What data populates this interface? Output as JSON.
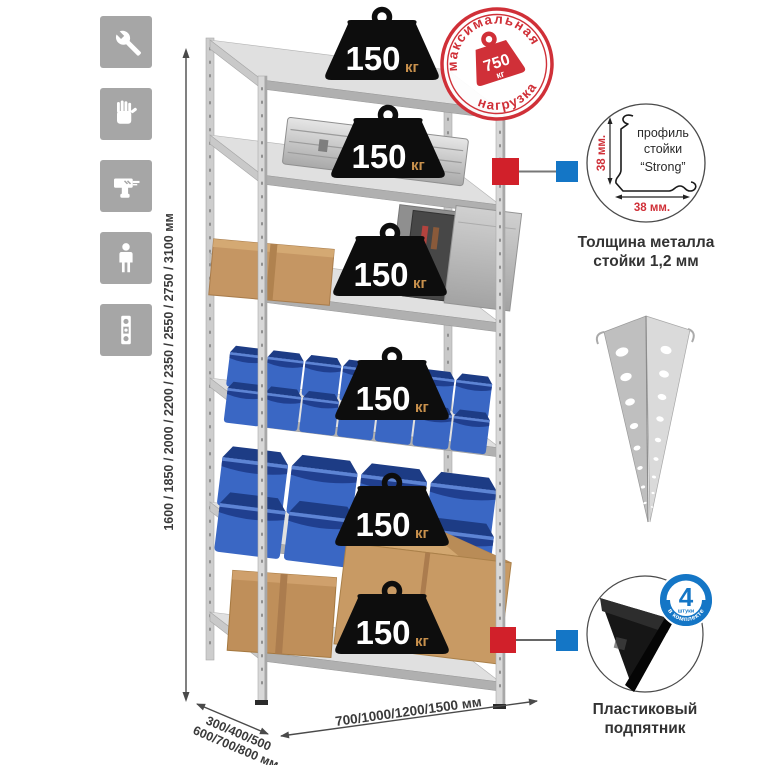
{
  "icons": {
    "items": [
      {
        "name": "wrench"
      },
      {
        "name": "gloves"
      },
      {
        "name": "drill"
      },
      {
        "name": "person"
      },
      {
        "name": "level"
      }
    ]
  },
  "stamp": {
    "arc_top": "максимальная",
    "arc_bottom": "нагрузка",
    "value": "750",
    "unit": "кг"
  },
  "shelf_load": {
    "value": "150",
    "unit": "кг",
    "shelves_count": 6
  },
  "dimensions": {
    "height": "1600 / 1850 / 2000 / 2200 / 2350 / 2550 / 2750 / 3100 мм",
    "depth_line1": "300/400/500",
    "depth_line2": "600/700/800 мм",
    "width": "700/1000/1200/1500 мм"
  },
  "profile": {
    "line1": "профиль",
    "line2": "стойки",
    "line3": "“Strong”",
    "dim_v": "38 мм.",
    "dim_h": "38 мм.",
    "caption1": "Толщина металла",
    "caption2": "стойки 1,2 мм"
  },
  "foot": {
    "badge_value": "4",
    "badge_sub": "штуки",
    "badge_arc": "в комплекте",
    "caption1": "Пластиковый",
    "caption2": "подпятник"
  },
  "colors": {
    "accent_red": "#d03038",
    "accent_blue": "#1476c6",
    "bin_blue": "#3a67c4",
    "icon_gray": "#a6a6a6"
  }
}
